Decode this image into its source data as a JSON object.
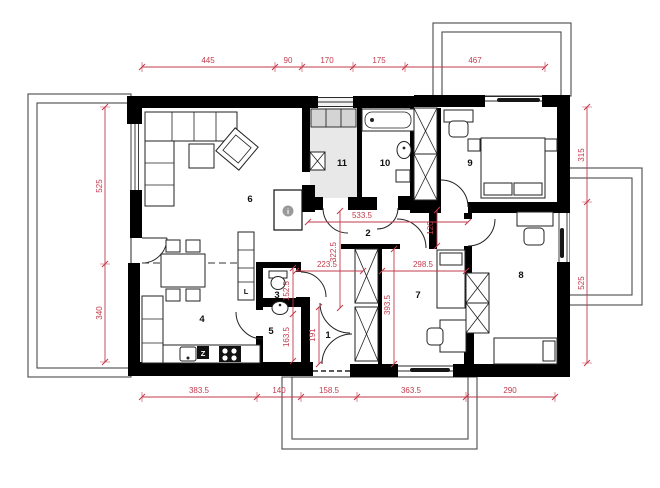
{
  "plan": {
    "type": "architectural-floor-plan",
    "rooms": [
      "1",
      "2",
      "3",
      "4",
      "5",
      "6",
      "7",
      "8",
      "9",
      "10",
      "11"
    ],
    "dims": {
      "top": [
        "445",
        "90",
        "170",
        "175",
        "467"
      ],
      "left": [
        "525",
        "340"
      ],
      "right": [
        "315",
        "525"
      ],
      "bottom": [
        "383.5",
        "140",
        "158.5",
        "363.5",
        "290"
      ],
      "inner": [
        "533.5",
        "322.5",
        "223.5",
        "298.5",
        "120",
        "393.5",
        "152.5",
        "163.5",
        "191"
      ]
    },
    "appliances": {
      "fridge": "L",
      "stove": "Z",
      "info": "i"
    },
    "colors": {
      "dimension": "#c23b4d",
      "wall": "#000000",
      "hall_floor": "#e8e8e8",
      "cabinet_fill": "#d4d4d4",
      "terrace_line": "#4a4a4a"
    }
  }
}
